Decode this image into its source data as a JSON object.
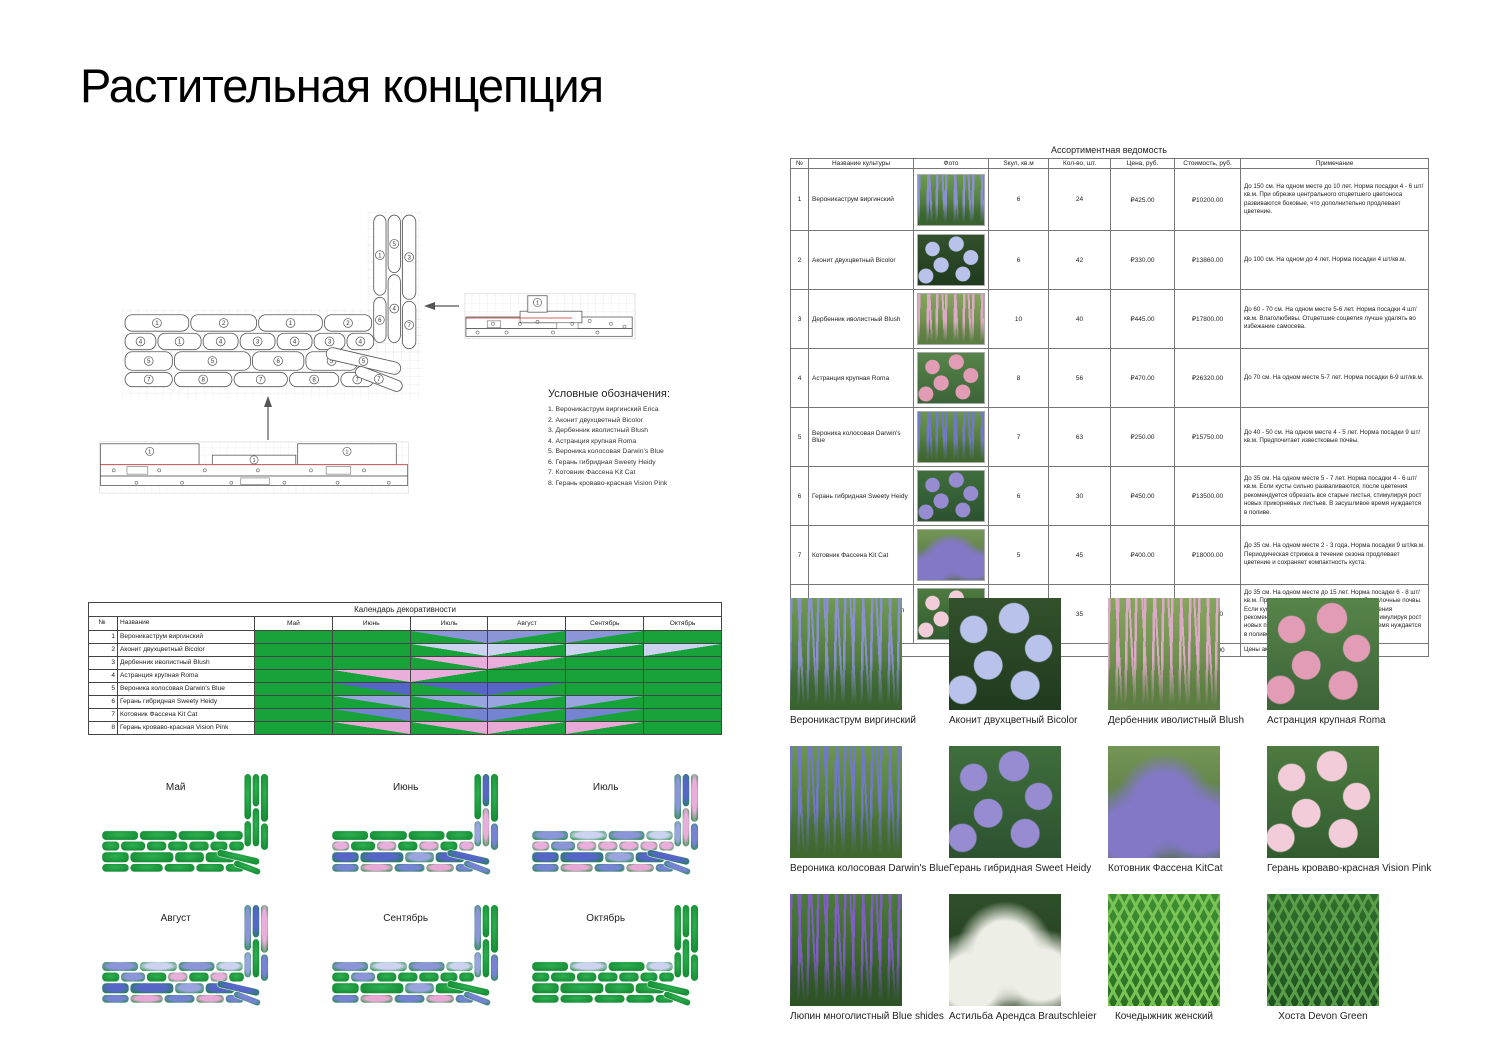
{
  "title": "Растительная концепция",
  "plan": {
    "rows": [
      [
        1,
        2,
        1,
        2
      ],
      [
        4,
        1,
        4,
        3,
        4,
        3,
        4
      ],
      [
        5,
        5,
        6,
        5
      ],
      [
        7,
        8,
        7,
        8,
        7
      ]
    ],
    "arm": [
      1,
      5,
      3,
      6,
      4,
      7
    ],
    "corner": [
      5,
      7
    ],
    "legend_title": "Условные обозначения:",
    "legend_items": [
      "1. Вероникаструм виргинский Erica",
      "2. Аконит двухцветный Bicolor",
      "3. Дербенник иволистный Blush",
      "4. Астранция крупная Roma",
      "5. Вероника колосовая Darwin's Blue",
      "6. Герань гибридная Sweety Heidy",
      "7. Котовник Фассена Kit Cat",
      "8. Герань кроваво-красная Vision Pink"
    ]
  },
  "assortment": {
    "title": "Ассортиментная ведомость",
    "columns": [
      "№",
      "Название культуры",
      "Фото",
      "Sкул, кв.м",
      "Кол-во, шт.",
      "Цена, руб.",
      "Стоимость, руб.",
      "Примечание"
    ],
    "rows": [
      {
        "num": "1",
        "name": "Вероникаструм виргинский",
        "area": "6",
        "qty": "24",
        "price": "₽425.00",
        "cost": "₽10200.00",
        "photo_ref": 0,
        "note": "До 150 см. На одном месте до 10 лет. Норма посадки 4 - 6 шт/кв.м. При обрезке центрального отцветшего цветоноса развиваются боковые, что дополнительно продлевает цветение."
      },
      {
        "num": "2",
        "name": "Аконит двухцветный Bicolor",
        "area": "6",
        "qty": "42",
        "price": "₽330.00",
        "cost": "₽13860.00",
        "photo_ref": 1,
        "note": "До 100 см. На одном  до 4 лет. Норма посадки 4 шт/кв.м."
      },
      {
        "num": "3",
        "name": "Дербенник иволистный Blush",
        "area": "10",
        "qty": "40",
        "price": "₽445.00",
        "cost": "₽17800.00",
        "photo_ref": 2,
        "note": "До 60 - 70 см. На одном месте 5-6 лет. Норма посадки 4 шт/кв.м. Влаголюбивы. Отцветшие соцветия лучше удалять во избежание самосева."
      },
      {
        "num": "4",
        "name": "Астранция крупная Roma",
        "area": "8",
        "qty": "56",
        "price": "₽470.00",
        "cost": "₽26320.00",
        "photo_ref": 3,
        "note": "До 70 см. На одном месте 5-7 лет. Норма посадки 6-9 шт/кв.м."
      },
      {
        "num": "5",
        "name": "Вероника колосовая Darwin's Blue",
        "area": "7",
        "qty": "63",
        "price": "₽250.00",
        "cost": "₽15750.00",
        "photo_ref": 4,
        "note": "До 40 - 50 см. На одном месте 4 - 5 лет. Норма посадки 9 шт/кв.м. Предпочитает известковые почвы."
      },
      {
        "num": "6",
        "name": "Герань гибридная Sweety Heidy",
        "area": "6",
        "qty": "30",
        "price": "₽450.00",
        "cost": "₽13500.00",
        "photo_ref": 5,
        "note": "До 35 см. На одном месте 5 - 7 лет. Норма посадки 4 - 6 шт/кв.м. Если кусты сильно разваливаются, после цветения рекомендуется обрезать все старые листья, стимулируя рост новых прикорневых листьев. В засушливое время нуждается в поливе."
      },
      {
        "num": "7",
        "name": "Котовник Фассена Kit Cat",
        "area": "5",
        "qty": "45",
        "price": "₽400.00",
        "cost": "₽18000.00",
        "photo_ref": 6,
        "note": "До 35 см. На одном месте 2 - 3 года. Норма посадки 9 шт/кв.м. Периодическая стрижка в течение сезона продлевает цветение и сохраняет компактность куста."
      },
      {
        "num": "8",
        "name": "Герань кроваво-красная Vision Pink",
        "area": "5",
        "qty": "35",
        "price": "₽450.00",
        "cost": "₽15750.00",
        "photo_ref": 7,
        "note": "До 35 см. На одном месте до 15 лет. Норма посадки 6 - 8 шт/кв.м. Предпочитает нейтральные или слабощелочные почвы. Если кусты сильно разваливаются, после цветения рекомендуется обрезать все старые листья, стимулируя рост новых прикорневых листьев. В засушливое время нуждается в поливе."
      }
    ],
    "total_label": "Итого",
    "total_value": "₽131180.00",
    "total_note": "Цены актуальны на июнь 2024 г."
  },
  "calendar": {
    "title": "Календарь декоративности",
    "columns": [
      "№",
      "Название",
      "Май",
      "Июнь",
      "Июль",
      "Август",
      "Сентябрь",
      "Октябрь"
    ],
    "green": "#18a23a",
    "rows": [
      {
        "num": "1",
        "name": "Вероникаструм виргинский",
        "color": "#8d95d9",
        "cells": [
          "g",
          "g",
          "up",
          "down",
          "down",
          "g"
        ]
      },
      {
        "num": "2",
        "name": "Аконит двухцветный Bicolor",
        "color": "#ccd2ef",
        "cells": [
          "g",
          "g",
          "up",
          "down",
          "down",
          "down"
        ]
      },
      {
        "num": "3",
        "name": "Дербенник иволистный Blush",
        "color": "#e9aedb",
        "cells": [
          "g",
          "g",
          "up",
          "down",
          "g",
          "g"
        ]
      },
      {
        "num": "4",
        "name": "Астранция крупная Roma",
        "color": "#e9aedb",
        "cells": [
          "g",
          "up",
          "down",
          "g",
          "g",
          "g"
        ]
      },
      {
        "num": "5",
        "name": "Вероника колосовая Darwin's Blue",
        "color": "#5566c6",
        "cells": [
          "g",
          "up",
          "up",
          "down",
          "g",
          "g"
        ]
      },
      {
        "num": "6",
        "name": "Герань гибридная Sweety Heidy",
        "color": "#9aa5e0",
        "cells": [
          "g",
          "up",
          "up",
          "down",
          "down",
          "g"
        ]
      },
      {
        "num": "7",
        "name": "Котовник Фассена Kit Cat",
        "color": "#7583d2",
        "cells": [
          "g",
          "up",
          "up",
          "down",
          "down",
          "g"
        ]
      },
      {
        "num": "8",
        "name": "Герань кроваво-красная Vision Pink",
        "color": "#e9a9d6",
        "cells": [
          "g",
          "up",
          "up",
          "down",
          "down",
          "g"
        ]
      }
    ]
  },
  "months": {
    "labels": [
      "Май",
      "Июнь",
      "Июль",
      "Август",
      "Сентябрь",
      "Октябрь"
    ],
    "bloom": [
      [],
      [
        4,
        5,
        6,
        7,
        8
      ],
      [
        1,
        2,
        3,
        4,
        5,
        6,
        7,
        8
      ],
      [
        1,
        2,
        3,
        5,
        6,
        7,
        8
      ],
      [
        1,
        2,
        6,
        7,
        8
      ],
      [
        2
      ]
    ],
    "plant_colors": {
      "1": "#8d95d9",
      "2": "#ccd2ef",
      "3": "#e9aedb",
      "4": "#e9aedb",
      "5": "#5566c6",
      "6": "#9aa5e0",
      "7": "#7583d2",
      "8": "#e9a9d6"
    }
  },
  "gallery": {
    "items": [
      {
        "caption": "Вероникаструм виргинский",
        "photo": {
          "pattern": "spikes",
          "flower": "#8a90cf",
          "leaf": "#6f9a52",
          "leaf2": "#39632f"
        }
      },
      {
        "caption": "Аконит двухцветный Bicolor",
        "photo": {
          "pattern": "dots",
          "flower": "#b9c2ea",
          "leaf": "#33512c",
          "leaf2": "#1f3a1e"
        }
      },
      {
        "caption": "Дербенник иволистный Blush",
        "photo": {
          "pattern": "spikes",
          "flower": "#dcaac6",
          "leaf": "#86a55e",
          "leaf2": "#5c7e42"
        }
      },
      {
        "caption": "Астранция крупная Roma",
        "photo": {
          "pattern": "dots",
          "flower": "#e39cb6",
          "leaf": "#57854a",
          "leaf2": "#3c6338"
        }
      },
      {
        "caption": "Вероника колосовая Darwin's Blue",
        "photo": {
          "pattern": "spikes",
          "flower": "#7079c8",
          "leaf": "#6c9551",
          "leaf2": "#41682f"
        }
      },
      {
        "caption": "Герань гибридная Sweet Heidy",
        "photo": {
          "pattern": "dots",
          "flower": "#978cd2",
          "leaf": "#3f6e3c",
          "leaf2": "#2c5230"
        }
      },
      {
        "caption": "Котовник Фассена KitCat",
        "photo": {
          "pattern": "mass",
          "flower": "#8278c5",
          "leaf": "#739555",
          "leaf2": "#4c6e3c"
        }
      },
      {
        "caption": "Герань кроваво-красная Vision Pink",
        "photo": {
          "pattern": "dots",
          "flower": "#f2cdd9",
          "leaf": "#4d7a40",
          "leaf2": "#325c30"
        }
      },
      {
        "caption": "Люпин многолистный Blue shides",
        "photo": {
          "pattern": "spikes",
          "flower": "#7e5fc0",
          "leaf": "#4c7a3a",
          "leaf2": "#2e5426"
        }
      },
      {
        "caption": "Астильба Арендса Brautschleier",
        "photo": {
          "pattern": "mass",
          "flower": "#edeee6",
          "leaf": "#2f4f2a",
          "leaf2": "#1d3619"
        }
      },
      {
        "caption": "Кочедыжник женский",
        "photo": {
          "pattern": "fronds",
          "flower": "#79c455",
          "leaf": "#3f8f33",
          "leaf2": "#2a6e22"
        }
      },
      {
        "caption": "Хоста Devon Green",
        "photo": {
          "pattern": "fronds",
          "flower": "#5a9e49",
          "leaf": "#2f6e2c",
          "leaf2": "#1e5220"
        }
      }
    ]
  }
}
